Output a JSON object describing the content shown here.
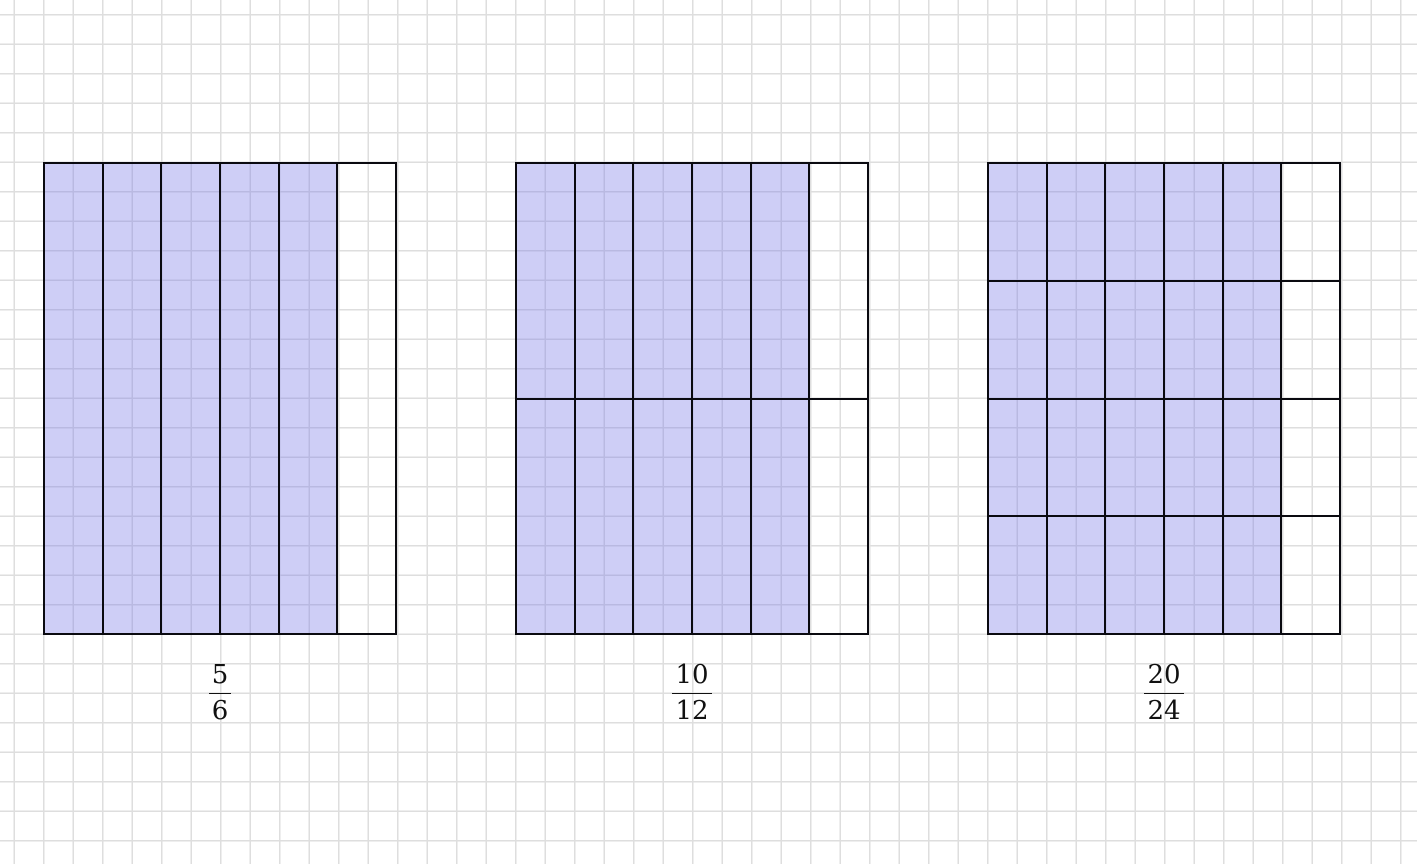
{
  "figures": [
    {
      "name": "five-sixths",
      "numerator": "5",
      "denominator": "6",
      "rows": 1,
      "cols": 6,
      "shaded_columns": 5,
      "shaded_cells": 5,
      "total_cells": 6
    },
    {
      "name": "ten-twelfths",
      "numerator": "10",
      "denominator": "12",
      "rows": 2,
      "cols": 6,
      "shaded_columns": 5,
      "shaded_cells": 10,
      "total_cells": 12
    },
    {
      "name": "twenty-twenty-fourths",
      "numerator": "20",
      "denominator": "24",
      "rows": 4,
      "cols": 6,
      "shaded_columns": 5,
      "shaded_cells": 20,
      "total_cells": 24
    }
  ],
  "colors": {
    "shaded_fill": "#cecdf6",
    "cell_border": "#0a0a10",
    "grid_line": "#dedede",
    "background": "#ffffff",
    "label_color": "#111111"
  }
}
